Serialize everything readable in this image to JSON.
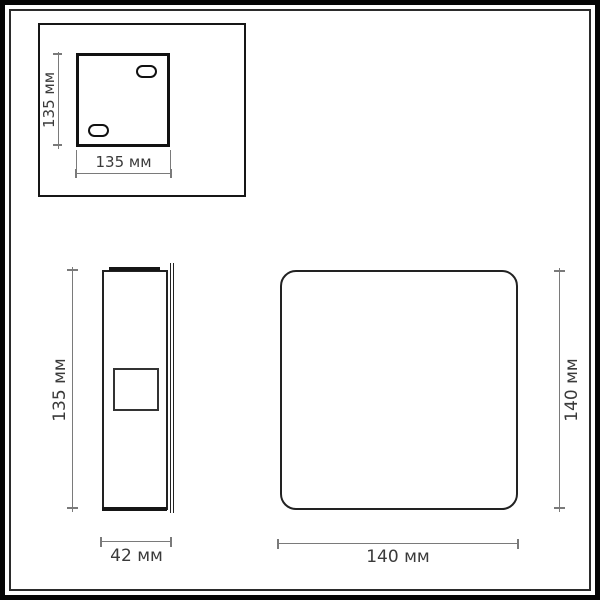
{
  "drawing": {
    "top_view": {
      "height_label": "135 мм",
      "width_label": "135 мм"
    },
    "side_view": {
      "height_label": "135 мм",
      "depth_label": "42 мм"
    },
    "front_view": {
      "height_label": "140 мм",
      "width_label": "140 мм"
    },
    "colors": {
      "background": "#ffffff",
      "frame": "#050505",
      "object_outline": "#1d1d1d",
      "dimension_line": "#7a7a7a",
      "label_text": "#3a3a3a"
    }
  }
}
